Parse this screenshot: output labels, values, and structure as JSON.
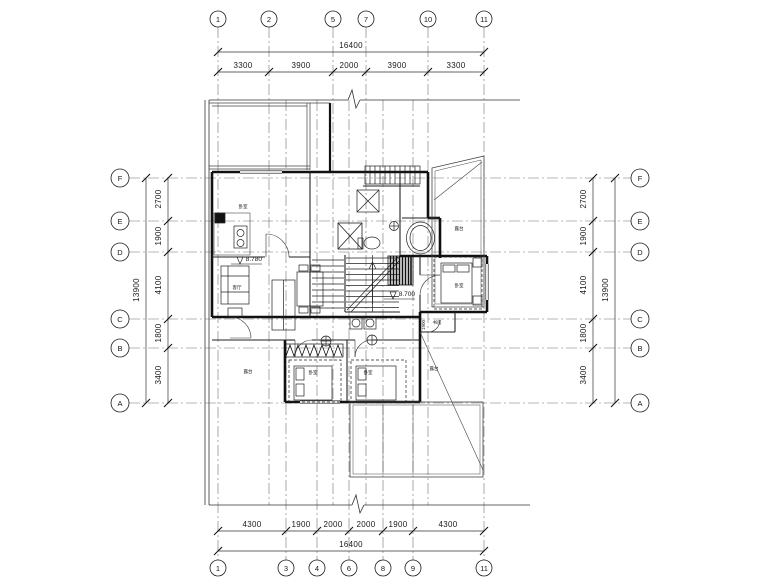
{
  "grid": {
    "top": [
      "1",
      "2",
      "5",
      "7",
      "10",
      "11"
    ],
    "bottom": [
      "1",
      "3",
      "4",
      "6",
      "8",
      "9",
      "11"
    ],
    "left": [
      "F",
      "E",
      "D",
      "C",
      "B",
      "A"
    ],
    "right": [
      "F",
      "E",
      "D",
      "C",
      "B",
      "A"
    ]
  },
  "dims": {
    "top": {
      "total": "16400",
      "segments": [
        "3300",
        "3900",
        "2000",
        "3900",
        "3300"
      ]
    },
    "bottom": {
      "total": "16400",
      "segments": [
        "4300",
        "1900",
        "2000",
        "2000",
        "1900",
        "4300"
      ]
    },
    "left": {
      "total": "13900",
      "segments": [
        "2700",
        "1900",
        "4100",
        "1800",
        "3400"
      ]
    },
    "right": {
      "total": "13900",
      "segments": [
        "2700",
        "1900",
        "4100",
        "1800",
        "3400"
      ]
    }
  },
  "annotations": {
    "elevation_upper": "8.780",
    "elevation_lower": "8.700",
    "room_dim": "1900"
  },
  "rooms": {
    "bedroom_tl": "卧室",
    "living": "客厅",
    "bedroom_b1": "卧室",
    "bedroom_b2": "卧室",
    "bedroom_r": "卧室",
    "study": "书房",
    "terrace_tr": "露台",
    "terrace_b": "露台",
    "terrace_l": "露台"
  },
  "colors": {
    "ink": "#1a1a1a",
    "grid": "#707070",
    "bg": "#ffffff"
  }
}
